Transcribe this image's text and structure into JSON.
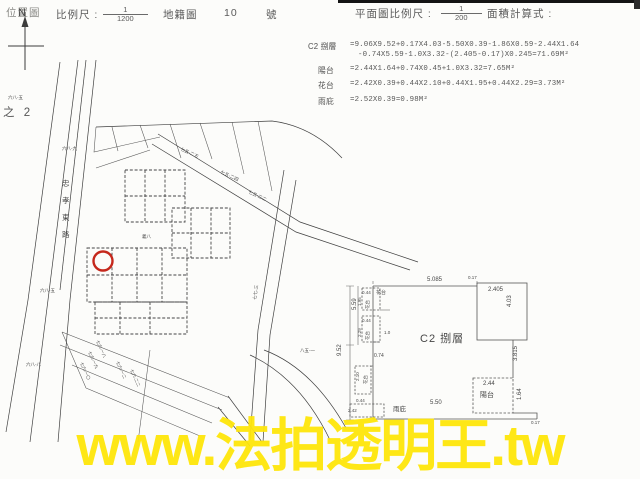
{
  "doc": {
    "header_left": {
      "title": "位置圖",
      "scale_label": "比例尺 :",
      "scale_numerator": "1",
      "scale_denominator": "1200",
      "map_label": "地籍圖",
      "sheet_number": "10",
      "number_suffix": "號"
    },
    "compass_label": "N",
    "margin_note": "之 2",
    "header_right": {
      "title": "平面圖比例尺 :",
      "scale_numerator": "1",
      "scale_denominator": "200",
      "calc_label": "面積計算式 :"
    }
  },
  "area_calcs": {
    "rows": [
      {
        "label": "C2 捌層",
        "line1": "=9.06X9.52+0.17X4.03-5.50X0.39-1.86X0.59-2.44X1.64",
        "line2": "-0.74X5.59-1.0X3.32-(2.405-0.17)X0.245=71.69M²"
      },
      {
        "label": "陽台",
        "line1": "=2.44X1.64+0.74X0.45+1.0X3.32=7.65M²",
        "line2": ""
      },
      {
        "label": "花台",
        "line1": "=2.42X0.39+0.44X2.10+0.44X1.95+0.44X2.29=3.73M²",
        "line2": ""
      },
      {
        "label": "雨庇",
        "line1": "=2.52X0.39=0.98M²",
        "line2": ""
      }
    ]
  },
  "site_map": {
    "road_name": "忠孝東路",
    "marker_color": "#c5281c",
    "lot_labels": [
      {
        "text": "六八-五",
        "x": 8,
        "y": 99,
        "s": 4.5,
        "r": 0
      },
      {
        "text": "六八-九",
        "x": 62,
        "y": 150,
        "s": 4.5,
        "r": 0
      },
      {
        "text": "七五-二五",
        "x": 180,
        "y": 150,
        "s": 4.5,
        "r": 25
      },
      {
        "text": "七五-二四",
        "x": 220,
        "y": 173,
        "s": 4.5,
        "r": 25
      },
      {
        "text": "七五-二二",
        "x": 248,
        "y": 193,
        "s": 4.5,
        "r": 25
      },
      {
        "text": "七七-三",
        "x": 256,
        "y": 300,
        "s": 4.5,
        "r": -82
      },
      {
        "text": "六八-五",
        "x": 40,
        "y": 292,
        "s": 4.5,
        "r": 0
      },
      {
        "text": "六八-八",
        "x": 26,
        "y": 366,
        "s": 4.5,
        "r": 0
      },
      {
        "text": "七六-一八",
        "x": 96,
        "y": 341,
        "s": 4.3,
        "r": 66
      },
      {
        "text": "七六-一九",
        "x": 88,
        "y": 352,
        "s": 4.3,
        "r": 66
      },
      {
        "text": "七六-一〇",
        "x": 80,
        "y": 363,
        "s": 4.3,
        "r": 66
      },
      {
        "text": "七六-一二",
        "x": 116,
        "y": 362,
        "s": 4.3,
        "r": 66
      },
      {
        "text": "七六-二二",
        "x": 130,
        "y": 370,
        "s": 4.3,
        "r": 66
      },
      {
        "text": "義八",
        "x": 142,
        "y": 238,
        "s": 4.5,
        "r": 0
      },
      {
        "text": "八五-一",
        "x": 300,
        "y": 352,
        "s": 4.5,
        "r": 0
      }
    ]
  },
  "floor_plan": {
    "unit_label": "C2 捌層",
    "labels": [
      {
        "text": "9.52",
        "x": 341,
        "y": 356,
        "s": 6,
        "r": -90
      },
      {
        "text": "5.59",
        "x": 356,
        "y": 310,
        "s": 6,
        "r": -90
      },
      {
        "text": "5.085",
        "x": 427,
        "y": 281,
        "s": 6,
        "r": 0
      },
      {
        "text": "0.17",
        "x": 468,
        "y": 279,
        "s": 4.5,
        "r": 0
      },
      {
        "text": "2.405",
        "x": 488,
        "y": 291,
        "s": 6,
        "r": 0
      },
      {
        "text": "4.03",
        "x": 511,
        "y": 307,
        "s": 6,
        "r": -90
      },
      {
        "text": "3.815",
        "x": 517,
        "y": 361,
        "s": 6,
        "r": -90
      },
      {
        "text": "2.44",
        "x": 483,
        "y": 385,
        "s": 6,
        "r": 0
      },
      {
        "text": "陽台",
        "x": 480,
        "y": 397,
        "s": 7,
        "r": 0
      },
      {
        "text": "1.64",
        "x": 521,
        "y": 400,
        "s": 6,
        "r": -90
      },
      {
        "text": "0.17",
        "x": 531,
        "y": 424,
        "s": 4.5,
        "r": 0
      },
      {
        "text": "5.50",
        "x": 430,
        "y": 404,
        "s": 6,
        "r": 0
      },
      {
        "text": "雨庇",
        "x": 393,
        "y": 411,
        "s": 6.5,
        "r": 0
      },
      {
        "text": "0.74",
        "x": 374,
        "y": 357,
        "s": 5,
        "r": 0
      },
      {
        "text": "0.44",
        "x": 362,
        "y": 294,
        "s": 4.5,
        "r": 0
      },
      {
        "text": "花台",
        "x": 376,
        "y": 294,
        "s": 5,
        "r": 0
      },
      {
        "text": "1.95",
        "x": 361,
        "y": 306,
        "s": 4.5,
        "r": -90
      },
      {
        "text": "花台",
        "x": 369,
        "y": 309,
        "s": 4.5,
        "r": -90
      },
      {
        "text": "0.44",
        "x": 362,
        "y": 322,
        "s": 4.5,
        "r": 0
      },
      {
        "text": "1.0",
        "x": 384,
        "y": 334,
        "s": 4.5,
        "r": 0
      },
      {
        "text": "2.29",
        "x": 361,
        "y": 337,
        "s": 4.5,
        "r": -90
      },
      {
        "text": "花台",
        "x": 369,
        "y": 340,
        "s": 4.5,
        "r": -90
      },
      {
        "text": "2.10",
        "x": 359,
        "y": 381,
        "s": 4.5,
        "r": -90
      },
      {
        "text": "花台",
        "x": 367,
        "y": 384,
        "s": 4.5,
        "r": -90
      },
      {
        "text": "0.44",
        "x": 356,
        "y": 402,
        "s": 4.5,
        "r": 0
      },
      {
        "text": "2.42",
        "x": 348,
        "y": 412,
        "s": 4.5,
        "r": 0
      }
    ]
  },
  "watermark": {
    "text": "www.法拍透明王.tw",
    "color": "#ffe60a"
  }
}
